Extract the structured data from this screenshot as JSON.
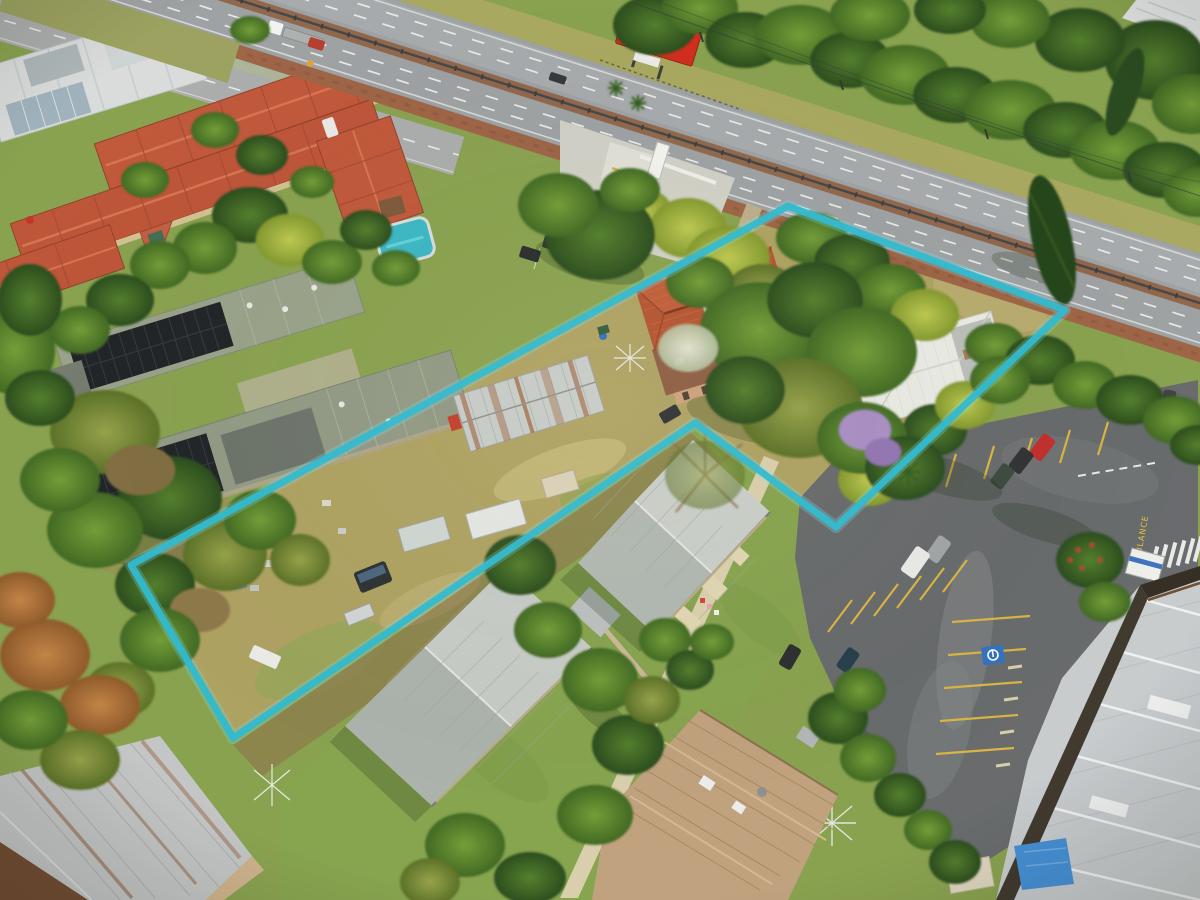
{
  "meta": {
    "type": "aerial-drone-photograph",
    "subject": "suburban development site beside a highway with a highlighted lot boundary"
  },
  "boundary": {
    "points": "788,206 1065,310 836,527 695,423 233,738 131,565",
    "stroke": "#2ab9d2",
    "glow": "#7ce4f2"
  },
  "billboard": {
    "panel_color": "#d0281b"
  },
  "road_marking": {
    "ambulance": "AMBULANCE",
    "color": "#e7c53d"
  },
  "palette": {
    "grass": "#85a04d",
    "dry_grass": "#aca061",
    "highway_asphalt": "#9ba0a5",
    "parking_asphalt": "#63676b",
    "median_dirt": "#8d6349",
    "townhouse_roof": "#bf5438",
    "subject_roof_terracotta": "#b2502e",
    "white_house_roof": "#e9ebe7",
    "grey_house_roof": "#c5cbc8",
    "tan_roof": "#bfa07e",
    "industrial_roof": "#c6cbd0",
    "solar_panel": "#191e24",
    "pool_teal": "#35b7c6",
    "tarp_blue": "#3f8ed8",
    "bay_line_yellow": "#d9b340"
  }
}
